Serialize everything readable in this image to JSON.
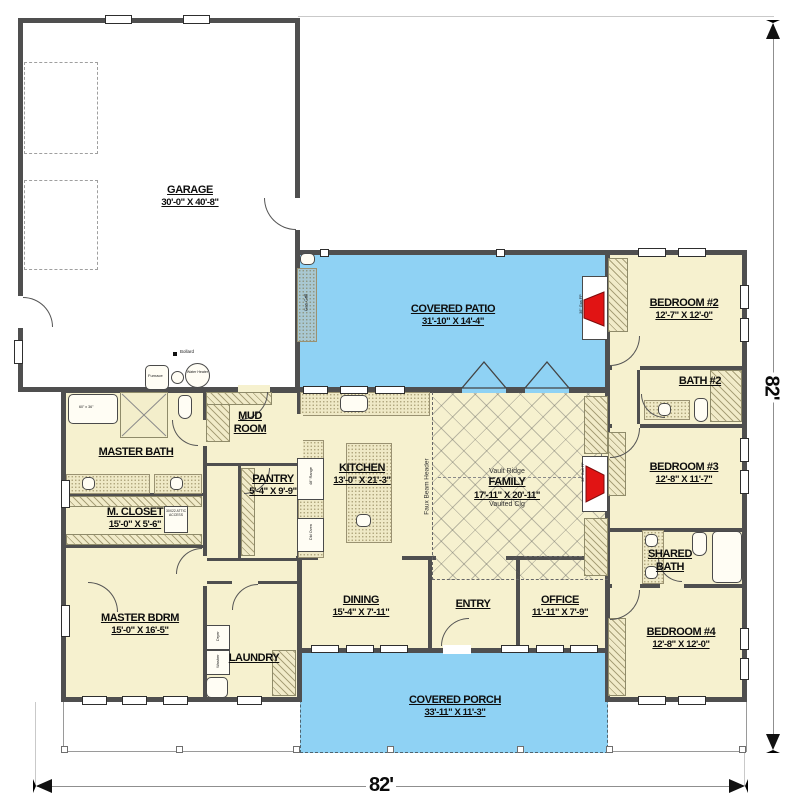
{
  "dimensions": {
    "right": "82'",
    "bottom": "82'"
  },
  "rooms": {
    "garage": {
      "name": "GARAGE",
      "dims": "30'-0\" X 40'-8\""
    },
    "covered_patio": {
      "name": "COVERED PATIO",
      "dims": "31'-10\" X 14'-4\""
    },
    "bedroom2": {
      "name": "BEDROOM #2",
      "dims": "12'-7\" X 12'-0\""
    },
    "bath2": {
      "name": "BATH #2"
    },
    "bedroom3": {
      "name": "BEDROOM #3",
      "dims": "12'-8\" X 11'-7\""
    },
    "shared_bath": {
      "name": "SHARED\nBATH"
    },
    "bedroom4": {
      "name": "BEDROOM #4",
      "dims": "12'-8\" X 12'-0\""
    },
    "master_bath": {
      "name": "MASTER BATH"
    },
    "m_closet": {
      "name": "M. CLOSET",
      "dims": "15'-0\" X 5'-6\""
    },
    "master_bdrm": {
      "name": "MASTER BDRM",
      "dims": "15'-0\" X 16'-5\""
    },
    "mud_room": {
      "name": "MUD\nROOM"
    },
    "pantry": {
      "name": "PANTRY",
      "dims": "5'-4\" X 9'-9\""
    },
    "kitchen": {
      "name": "KITCHEN",
      "dims": "13'-0\" X 21'-3\""
    },
    "family": {
      "name": "FAMILY",
      "dims": "17'-11\" X 20'-11\"",
      "note_top": "Vault Ridge",
      "note_bottom": "Vaulted Clg",
      "beam": "Faux Beam Header"
    },
    "dining": {
      "name": "DINING",
      "dims": "15'-4\" X 7'-11\""
    },
    "entry": {
      "name": "ENTRY"
    },
    "office": {
      "name": "OFFICE",
      "dims": "11'-11\" X 7'-9\""
    },
    "laundry": {
      "name": "LAUNDRY"
    },
    "covered_porch": {
      "name": "COVERED PORCH",
      "dims": "33'-11\" X 11'-3\""
    }
  },
  "fixtures": {
    "bollard": "Bollard",
    "furnace": "Furnace",
    "water_heater": "Water Heater",
    "gas_grill": "Gas Grill",
    "patio_fireplace": "36\" Gas FP",
    "family_fireplace": "36\" Gas FP",
    "tub_size": "60\" x 36\"",
    "attic_access": "30X22 ATTIC ACCESS",
    "range": "48\" Range",
    "double_oven": "Dbl Oven",
    "washer": "Washer",
    "dryer": "Dryer"
  },
  "colors": {
    "wall": "#4f4f4f",
    "room_fill": "#f6f1cf",
    "patio_fill": "#8fd2f4",
    "fireplace_red": "#e11414",
    "grill_counter": "#a9c8d2"
  }
}
